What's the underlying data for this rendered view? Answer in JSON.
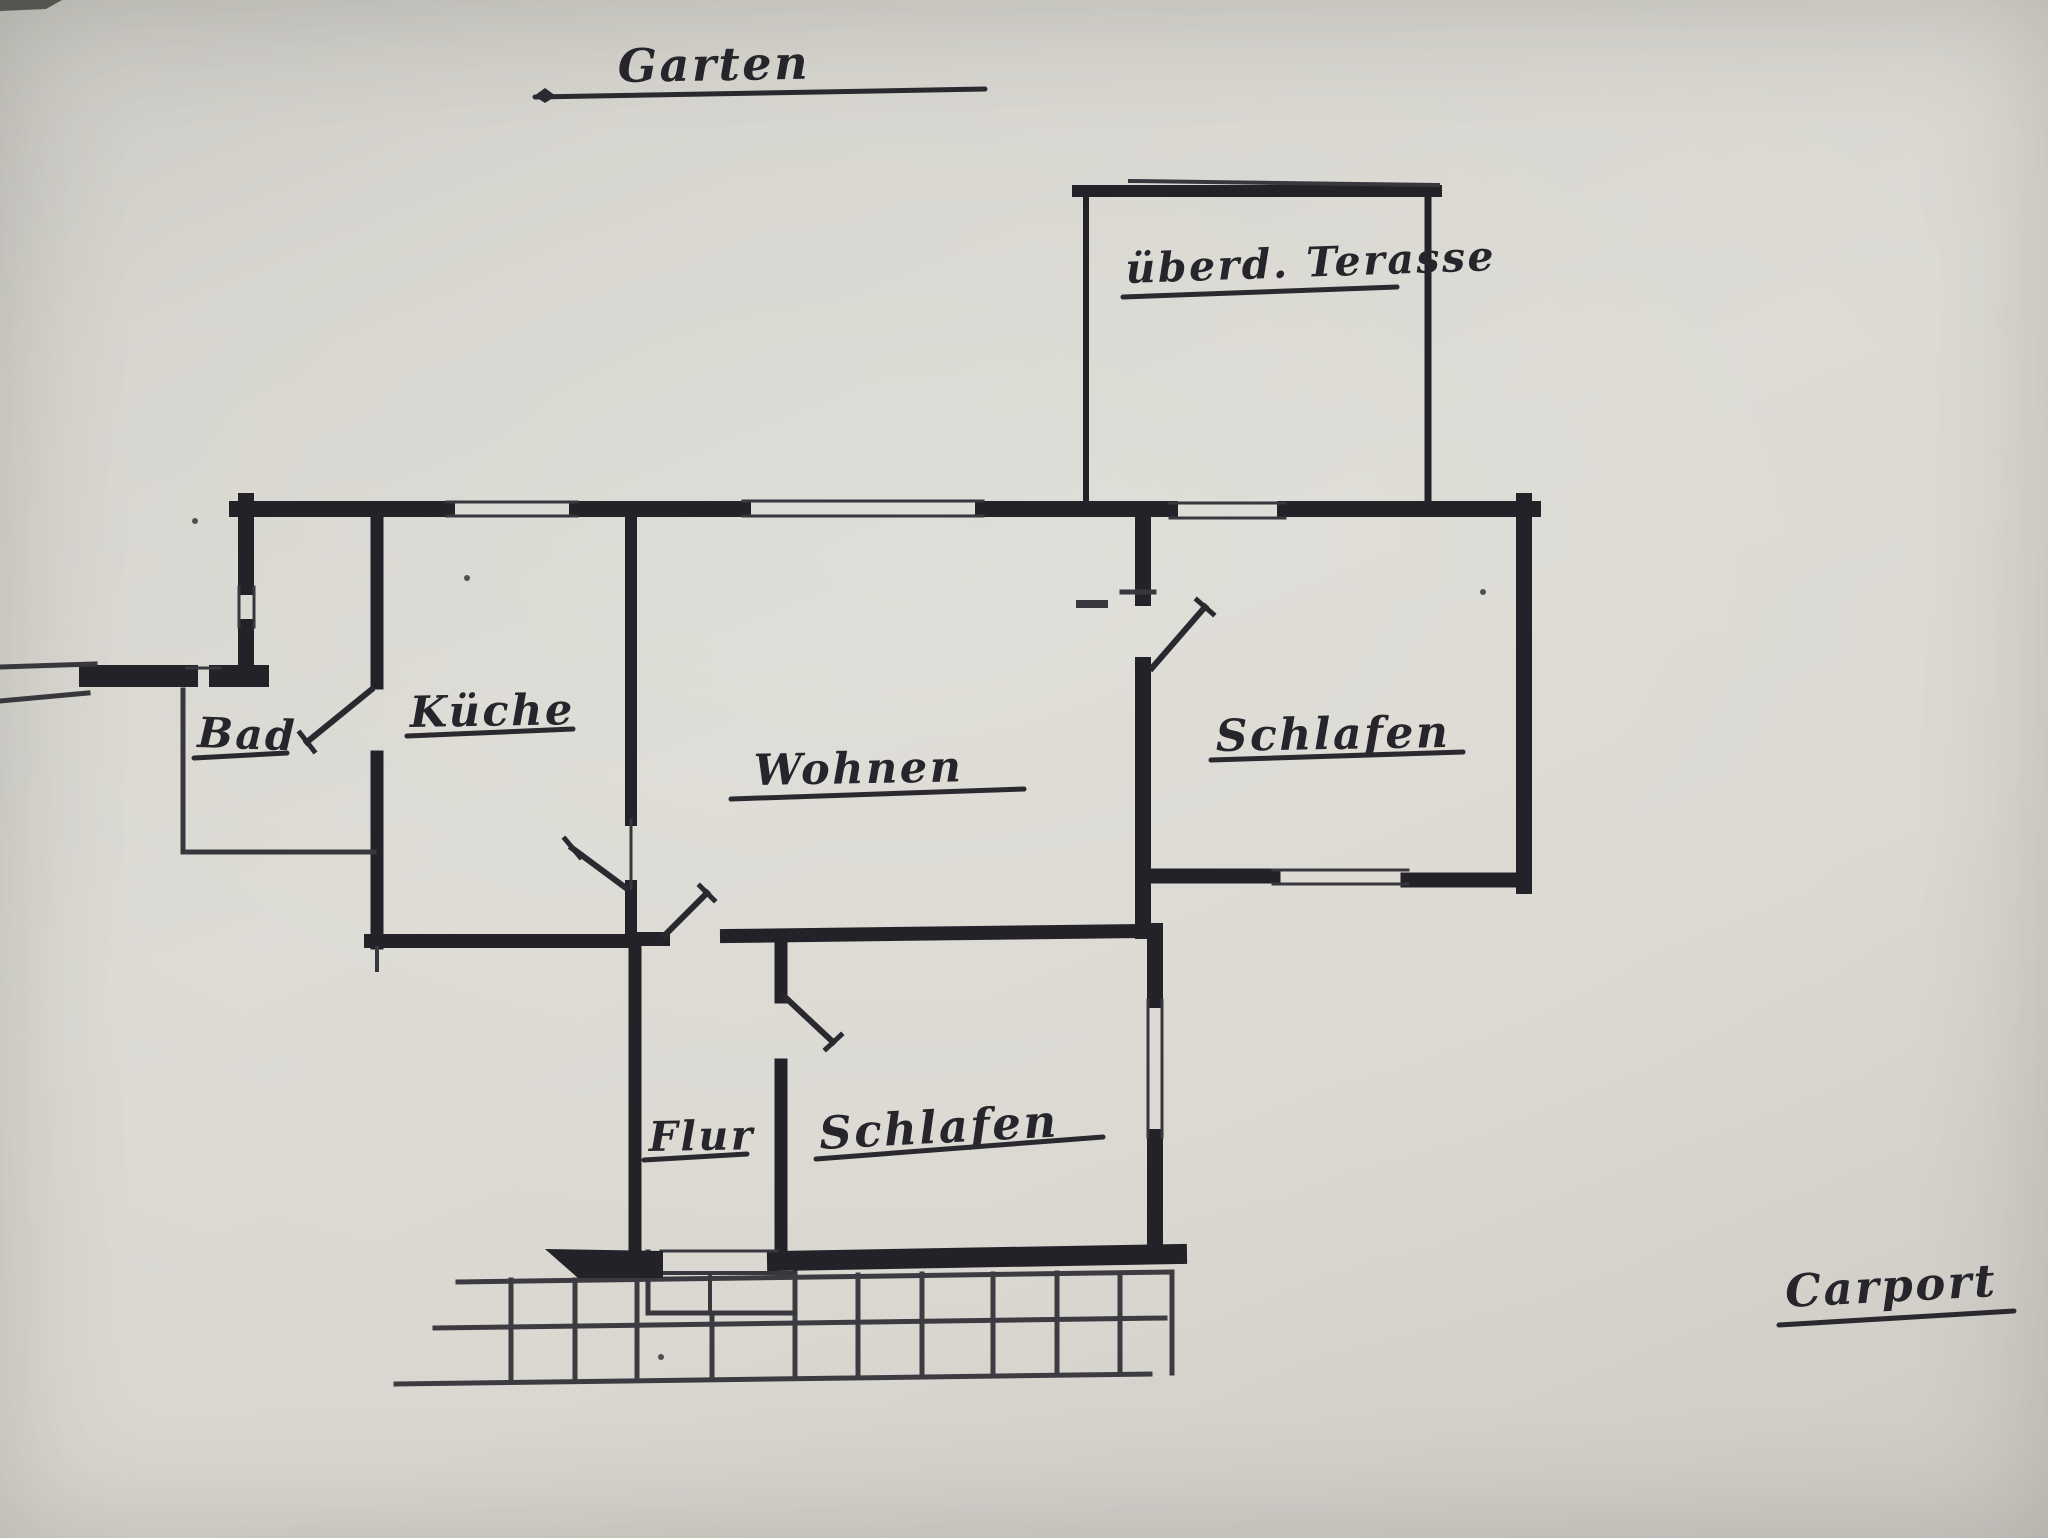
{
  "meta": {
    "description": "Hand-drawn house floor plan photographed on grey paper"
  },
  "palette": {
    "paper": "#d6d4cd",
    "ink_wall": "#232229",
    "ink_thin": "#38373e",
    "ink_door": "#2a2930",
    "ink_grid": "#3c3b42",
    "photo_edge": "#55544f"
  },
  "labels": [
    {
      "name": "area-label-garten",
      "text": "Garten",
      "x": 618,
      "y": 82,
      "size": 46,
      "rot": -1,
      "underline": [
        535,
        97,
        985,
        89
      ]
    },
    {
      "name": "room-label-terrasse",
      "text": "überd. Terasse",
      "x": 1126,
      "y": 283,
      "size": 41,
      "rot": -2,
      "underline": [
        1123,
        297,
        1397,
        287
      ]
    },
    {
      "name": "room-label-bad",
      "text": "Bad",
      "x": 197,
      "y": 747,
      "size": 42,
      "rot": 2,
      "underline": [
        194,
        758,
        287,
        753
      ]
    },
    {
      "name": "room-label-kueche",
      "text": "Küche",
      "x": 410,
      "y": 727,
      "size": 43,
      "rot": -1,
      "underline": [
        407,
        736,
        573,
        729
      ]
    },
    {
      "name": "room-label-wohnen",
      "text": "Wohnen",
      "x": 754,
      "y": 785,
      "size": 43,
      "rot": -1,
      "underline": [
        731,
        799,
        1024,
        789
      ]
    },
    {
      "name": "room-label-schlafen-east",
      "text": "Schlafen",
      "x": 1216,
      "y": 751,
      "size": 44,
      "rot": -1,
      "underline": [
        1211,
        760,
        1463,
        752
      ]
    },
    {
      "name": "room-label-flur",
      "text": "Flur",
      "x": 649,
      "y": 1151,
      "size": 41,
      "rot": -1,
      "underline": [
        644,
        1160,
        747,
        1154
      ]
    },
    {
      "name": "room-label-schlafen-south",
      "text": "Schlafen",
      "x": 820,
      "y": 1149,
      "size": 45,
      "rot": -3,
      "underline": [
        816,
        1159,
        1103,
        1137
      ]
    },
    {
      "name": "area-label-carport",
      "text": "Carport",
      "x": 1786,
      "y": 1307,
      "size": 45,
      "rot": -3,
      "underline": [
        1779,
        1325,
        2014,
        1311
      ]
    }
  ],
  "drawing": {
    "walls": [
      [
        237,
        509,
        447,
        509,
        16
      ],
      [
        577,
        509,
        743,
        509,
        16
      ],
      [
        983,
        509,
        1170,
        509,
        16
      ],
      [
        1285,
        509,
        1533,
        509,
        16
      ],
      [
        246,
        501,
        246,
        587,
        16
      ],
      [
        246,
        627,
        246,
        670,
        16
      ],
      [
        90,
        676,
        187,
        676,
        22
      ],
      [
        220,
        676,
        258,
        676,
        22
      ],
      [
        377,
        515,
        377,
        683,
        13
      ],
      [
        377,
        757,
        377,
        943,
        13
      ],
      [
        371,
        941,
        633,
        941,
        14
      ],
      [
        631,
        515,
        631,
        820,
        12
      ],
      [
        631,
        886,
        631,
        941,
        12
      ],
      [
        633,
        939,
        663,
        939,
        14
      ],
      [
        727,
        936,
        1140,
        931,
        14
      ],
      [
        635,
        939,
        635,
        1252,
        13
      ],
      [
        781,
        939,
        781,
        997,
        13
      ],
      [
        781,
        1065,
        781,
        1252,
        13
      ],
      [
        1155,
        931,
        1155,
        1000,
        16
      ],
      [
        1155,
        1137,
        1155,
        1252,
        16
      ],
      [
        777,
        1261,
        1177,
        1254,
        20
      ],
      [
        1143,
        517,
        1143,
        598,
        16
      ],
      [
        1143,
        665,
        1143,
        931,
        16
      ],
      [
        1150,
        876,
        1273,
        876,
        15
      ],
      [
        1408,
        880,
        1520,
        880,
        15
      ],
      [
        1524,
        501,
        1524,
        886,
        16
      ],
      [
        1086,
        188,
        1086,
        502,
        6
      ],
      [
        1428,
        193,
        1428,
        502,
        7
      ],
      [
        1078,
        191,
        1436,
        191,
        12
      ]
    ],
    "thin_lines": [
      [
        447,
        502,
        577,
        502,
        3
      ],
      [
        447,
        516,
        577,
        516,
        3
      ],
      [
        743,
        501,
        983,
        501,
        3
      ],
      [
        743,
        516,
        983,
        516,
        3
      ],
      [
        1170,
        503,
        1285,
        503,
        3
      ],
      [
        1170,
        518,
        1285,
        518,
        3
      ],
      [
        239,
        587,
        239,
        627,
        3
      ],
      [
        254,
        587,
        254,
        627,
        3
      ],
      [
        1273,
        870,
        1408,
        870,
        3
      ],
      [
        1273,
        884,
        1408,
        884,
        3
      ],
      [
        1148,
        1000,
        1148,
        1137,
        3
      ],
      [
        1162,
        1000,
        1162,
        1137,
        3
      ],
      [
        183,
        690,
        183,
        852,
        5
      ],
      [
        183,
        852,
        374,
        852,
        5
      ],
      [
        0,
        667,
        95,
        664,
        5
      ],
      [
        0,
        701,
        88,
        693,
        5
      ],
      [
        187,
        668,
        220,
        668,
        3
      ],
      [
        631,
        820,
        631,
        888,
        3
      ],
      [
        377,
        948,
        377,
        970,
        4
      ],
      [
        1122,
        592,
        1154,
        592,
        5
      ],
      [
        1080,
        604,
        1104,
        604,
        8
      ],
      [
        1130,
        181,
        1438,
        185,
        4
      ],
      [
        661,
        1251,
        777,
        1251,
        3
      ],
      [
        648,
        1273,
        795,
        1273,
        4
      ],
      [
        648,
        1252,
        648,
        1313,
        5
      ],
      [
        648,
        1313,
        795,
        1313,
        5
      ],
      [
        710,
        1274,
        710,
        1313,
        4
      ]
    ],
    "doors": [
      [
        307,
        742,
        371,
        690,
        6
      ],
      [
        300,
        733,
        314,
        751,
        5
      ],
      [
        572,
        848,
        626,
        888,
        6
      ],
      [
        565,
        839,
        580,
        857,
        5
      ],
      [
        665,
        935,
        707,
        893,
        6
      ],
      [
        700,
        886,
        714,
        900,
        5
      ],
      [
        1152,
        668,
        1205,
        607,
        6
      ],
      [
        1197,
        600,
        1213,
        614,
        5
      ],
      [
        786,
        998,
        833,
        1042,
        6
      ],
      [
        826,
        1049,
        841,
        1035,
        5
      ]
    ],
    "grid_lines": [
      [
        458,
        1282,
        1172,
        1272,
        5
      ],
      [
        435,
        1328,
        1165,
        1318,
        5
      ],
      [
        396,
        1384,
        1150,
        1374,
        5
      ],
      [
        511,
        1280,
        511,
        1382,
        5
      ],
      [
        575,
        1280,
        575,
        1381,
        5
      ],
      [
        637,
        1279,
        637,
        1380,
        5
      ],
      [
        712,
        1313,
        712,
        1379,
        5
      ],
      [
        795,
        1273,
        795,
        1377,
        5
      ],
      [
        858,
        1275,
        858,
        1377,
        5
      ],
      [
        922,
        1274,
        922,
        1376,
        5
      ],
      [
        993,
        1274,
        993,
        1375,
        5
      ],
      [
        1057,
        1273,
        1057,
        1374,
        5
      ],
      [
        1120,
        1273,
        1120,
        1374,
        5
      ],
      [
        1172,
        1272,
        1172,
        1373,
        5
      ]
    ],
    "polygons": [
      {
        "name": "entry-wedge-wall",
        "points": "545,1249 663,1251 663,1278 578,1278",
        "fill": "#232229"
      },
      {
        "name": "garten-line-diamond",
        "points": "534,96 545,88 556,96 545,103",
        "fill": "#2a2930"
      },
      {
        "name": "photo-corner-edge",
        "points": "0,0 62,0 46,9 0,11",
        "fill": "#55544f"
      }
    ],
    "specks": [
      [
        195,
        521,
        3
      ],
      [
        467,
        578,
        3
      ],
      [
        1483,
        592,
        3
      ],
      [
        661,
        1357,
        3
      ]
    ]
  }
}
